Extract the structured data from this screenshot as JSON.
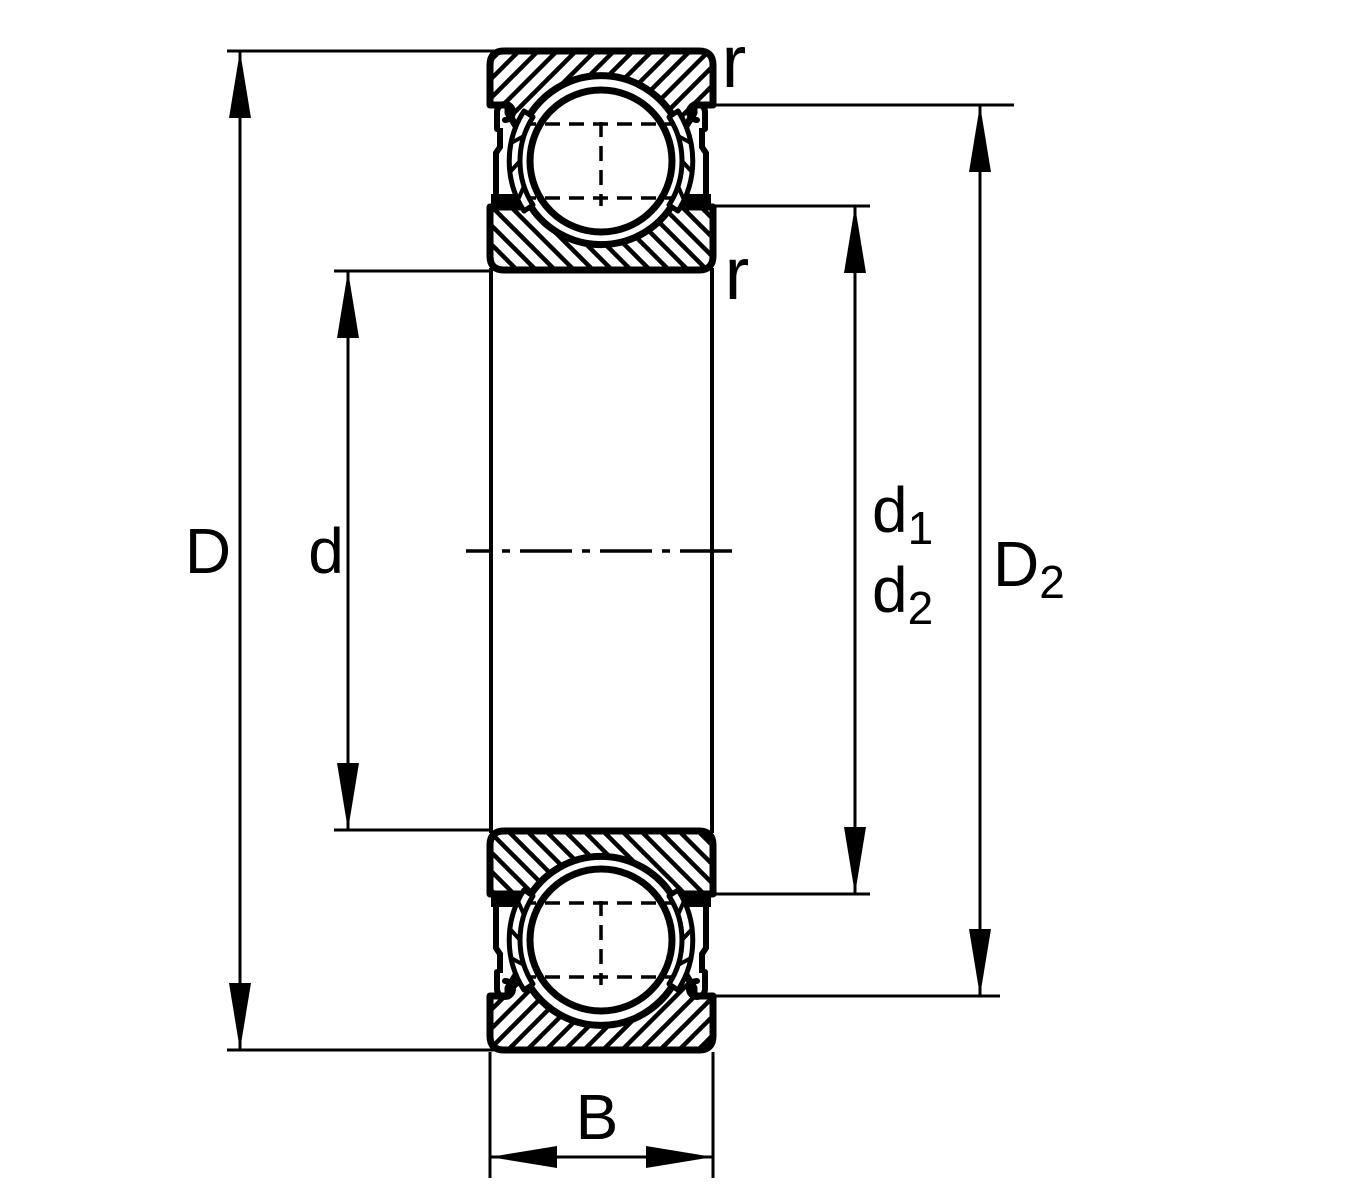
{
  "diagram": {
    "colors": {
      "line": "#000000",
      "background": "#ffffff"
    },
    "labels": {
      "outer_diameter": "D",
      "bore_diameter": "d",
      "d1_base": "d",
      "d1_sub": "1",
      "d2_base": "d",
      "d2_sub": "2",
      "D2_base": "D",
      "D2_sub": "2",
      "width": "B",
      "fillet_radius_top": "r",
      "fillet_radius_bottom": "r"
    }
  }
}
